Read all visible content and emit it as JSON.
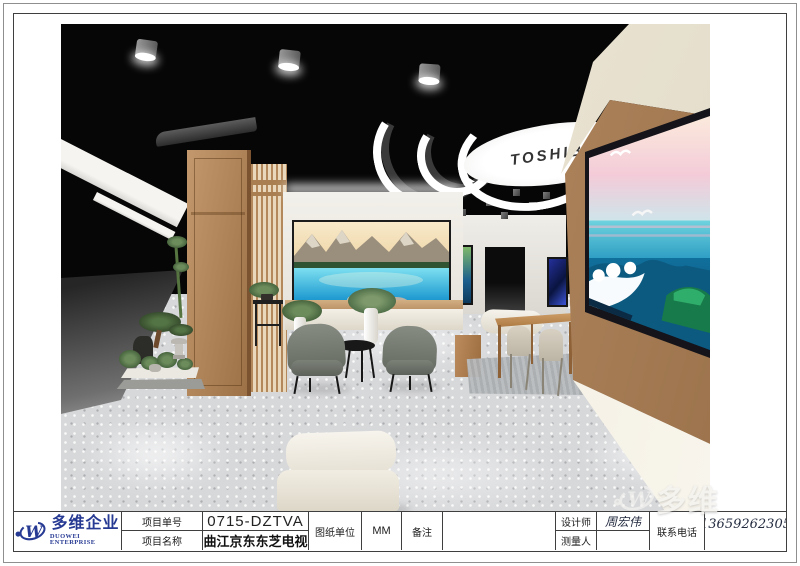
{
  "logo": {
    "company_cn": "多维企业",
    "company_en": "DUOWEI ENTERPRISE"
  },
  "title_block": {
    "project_no_label": "项目单号",
    "project_no": "0715-DZTVA",
    "project_name_label": "项目名称",
    "project_name": "曲江京东东芝电视",
    "drawing_unit_label": "图纸单位",
    "drawing_unit": "MM",
    "remark_label": "备注",
    "remark": "",
    "designer_label": "设计师",
    "designer": "周宏伟",
    "surveyor_label": "测量人",
    "surveyor": "",
    "phone_label": "联系电话",
    "phone": "13659262305"
  },
  "scene": {
    "ceiling_sign": "TOSHIBA"
  },
  "watermark": {
    "text": "多维"
  },
  "colors": {
    "brand_blue": "#273a93",
    "frame_gray": "#3f3f3f",
    "ceiling_black": "#060606",
    "wood": "#b98a5e"
  }
}
